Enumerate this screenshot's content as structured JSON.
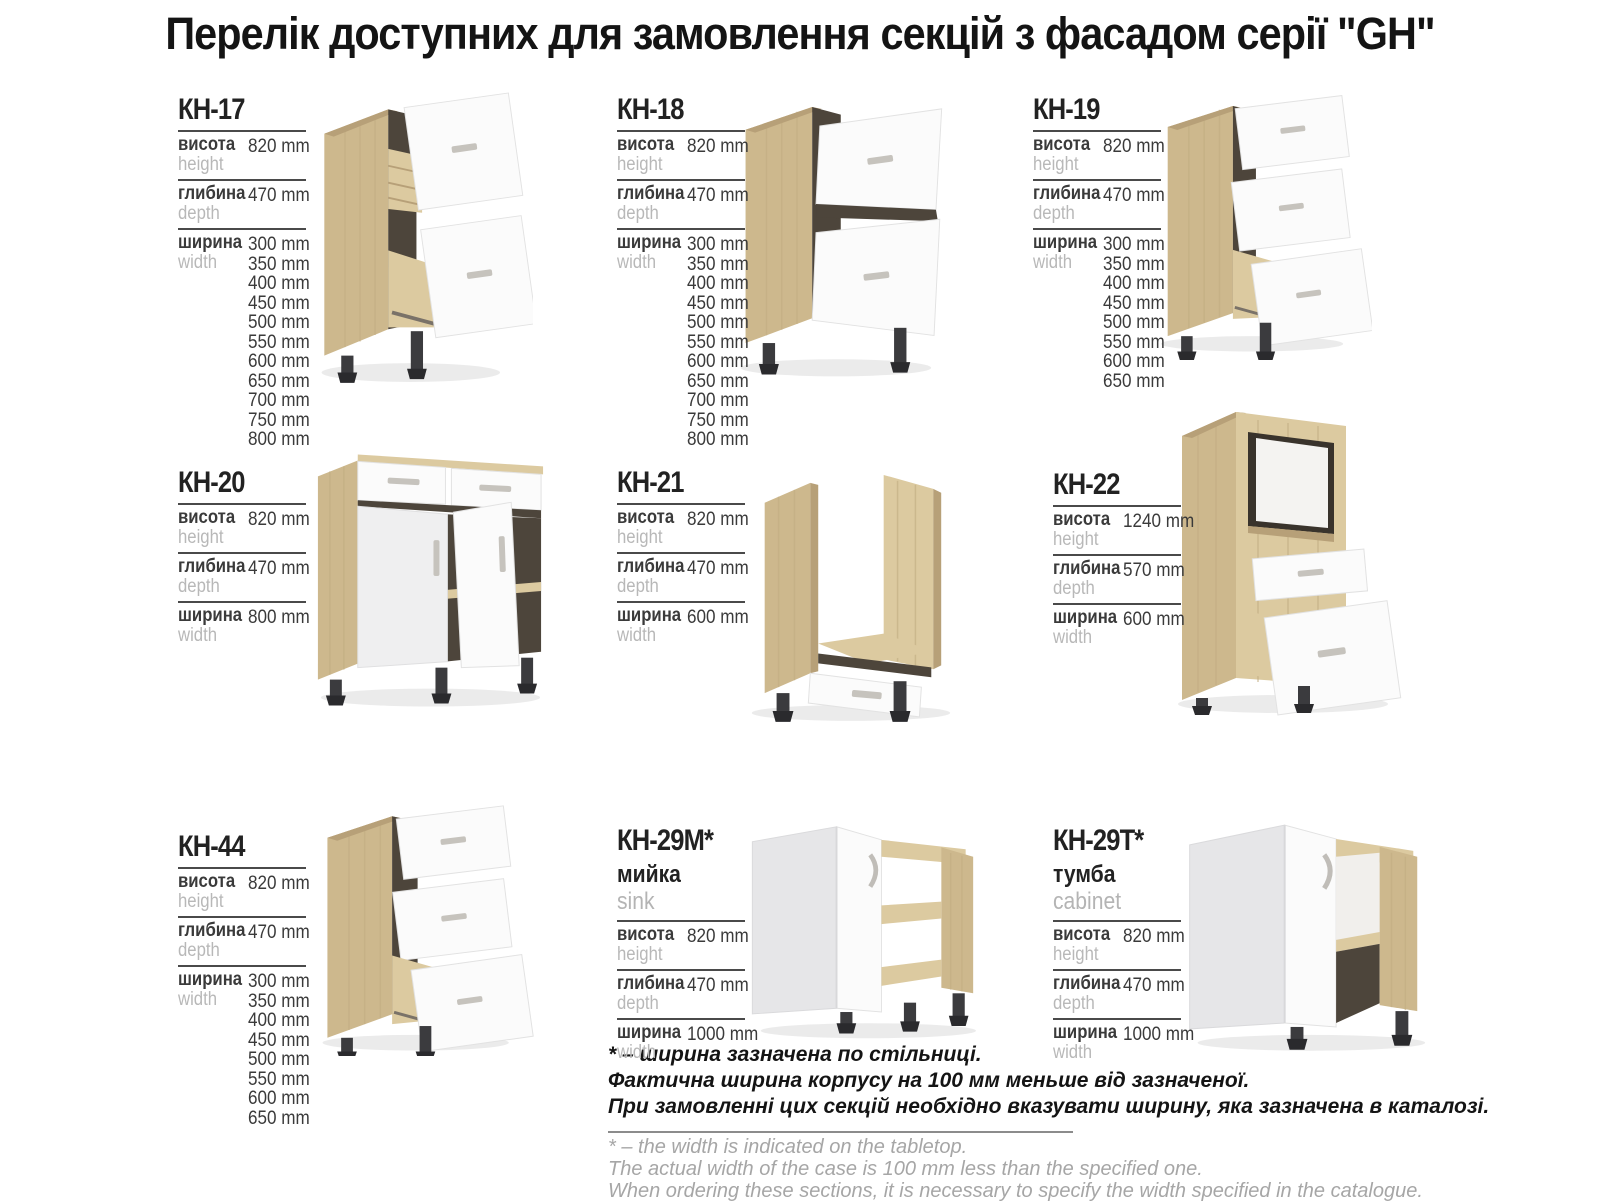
{
  "page_title": "Перелік доступних для замовлення секцій з фасадом серії \"GH\"",
  "labels": {
    "height_uk": "висота",
    "height_en": "height",
    "depth_uk": "глибина",
    "depth_en": "depth",
    "width_uk": "ширина",
    "width_en": "width"
  },
  "products": [
    {
      "model": "КН-17",
      "height": "820 mm",
      "depth": "470 mm",
      "widths": [
        "300 mm",
        "350 mm",
        "400 mm",
        "450 mm",
        "500 mm",
        "550 mm",
        "600 mm",
        "650 mm",
        "700 mm",
        "750 mm",
        "800 mm"
      ]
    },
    {
      "model": "КН-18",
      "height": "820 mm",
      "depth": "470 mm",
      "widths": [
        "300 mm",
        "350 mm",
        "400 mm",
        "450 mm",
        "500 mm",
        "550 mm",
        "600 mm",
        "650 mm",
        "700 mm",
        "750 mm",
        "800 mm"
      ]
    },
    {
      "model": "КН-19",
      "height": "820 mm",
      "depth": "470 mm",
      "widths": [
        "300 mm",
        "350 mm",
        "400 mm",
        "450 mm",
        "500 mm",
        "550 mm",
        "600 mm",
        "650 mm"
      ]
    },
    {
      "model": "КН-20",
      "height": "820 mm",
      "depth": "470 mm",
      "widths": [
        "800 mm"
      ]
    },
    {
      "model": "КН-21",
      "height": "820 mm",
      "depth": "470 mm",
      "widths": [
        "600 mm"
      ]
    },
    {
      "model": "КН-22",
      "height": "1240 mm",
      "depth": "570 mm",
      "widths": [
        "600 mm"
      ]
    },
    {
      "model": "КН-44",
      "height": "820 mm",
      "depth": "470 mm",
      "widths": [
        "300 mm",
        "350 mm",
        "400 mm",
        "450 mm",
        "500 mm",
        "550 mm",
        "600 mm",
        "650 mm"
      ]
    },
    {
      "model": "КН-29М*",
      "subtitle_uk": "мийка",
      "subtitle_en": "sink",
      "height": "820 mm",
      "depth": "470 mm",
      "widths": [
        "1000 mm"
      ]
    },
    {
      "model": "КН-29Т*",
      "subtitle_uk": "тумба",
      "subtitle_en": "cabinet",
      "height": "820 mm",
      "depth": "470 mm",
      "widths": [
        "1000 mm"
      ]
    }
  ],
  "footnotes": {
    "uk": [
      "* – ширина зазначена по стільниці.",
      "Фактична ширина корпусу на 100 мм меньше від зазначеної.",
      "При замовленні цих секцій необхідно вказувати ширину, яка зазначена в каталозі."
    ],
    "en": [
      "* – the width is indicated on the tabletop.",
      "The actual width of the case is 100 mm less than the specified one.",
      "When ordering these sections, it is necessary to specify the width specified in the catalogue."
    ]
  },
  "colors": {
    "wood": "#cdb88d",
    "front_white": "#fbfbfb",
    "interior_dark": "#4d453b",
    "feet": "#3b3b3e",
    "text_dark": "#3a3a3a",
    "text_muted": "#b8b8b8"
  }
}
